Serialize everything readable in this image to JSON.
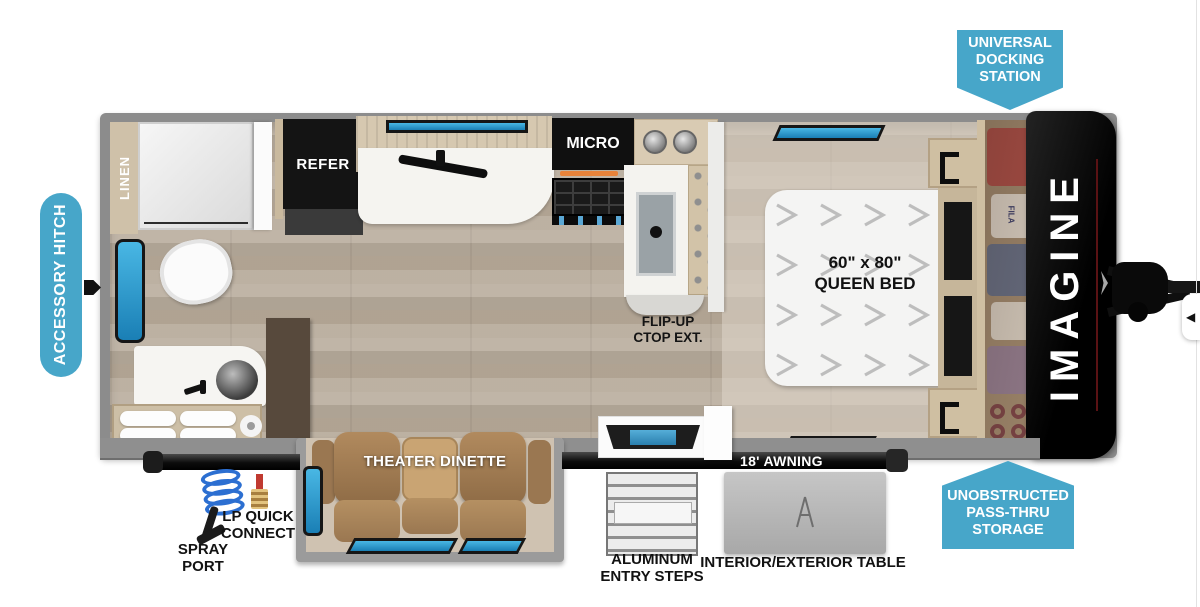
{
  "colors": {
    "badge_blue": "#47a6c9",
    "window_blue": "#2f9fd4",
    "cap_black": "#0d0d0d",
    "accent_orange": "#e8833a",
    "accent_red": "#5a1214",
    "floor_wood": "#b9ad9d"
  },
  "badges": {
    "accessory_hitch": {
      "label": "ACCESSORY HITCH"
    },
    "universal_docking": {
      "line1": "UNIVERSAL",
      "line2": "DOCKING",
      "line3": "STATION"
    },
    "pass_thru": {
      "line1": "UNOBSTRUCTED",
      "line2": "PASS-THRU",
      "line3": "STORAGE"
    }
  },
  "floorplan": {
    "brand": "IMAGINE",
    "linen": "LINEN",
    "refer": "REFER",
    "micro": "MICRO",
    "flip_up_line1": "FLIP-UP",
    "flip_up_line2": "CTOP EXT.",
    "bed_size": "60\" x 80\"",
    "bed_type": "QUEEN BED",
    "theater": "THEATER DINETTE",
    "awning": "18' AWNING",
    "wardrobe_brand": "FILA"
  },
  "exterior": {
    "spray_line1": "SPRAY",
    "spray_line2": "PORT",
    "lp_line1": "LP QUICK",
    "lp_line2": "CONNECT",
    "steps_line1": "ALUMINUM",
    "steps_line2": "ENTRY STEPS",
    "table_label": "INTERIOR/EXTERIOR TABLE"
  },
  "controls": {
    "prev_arrow": "◀"
  }
}
